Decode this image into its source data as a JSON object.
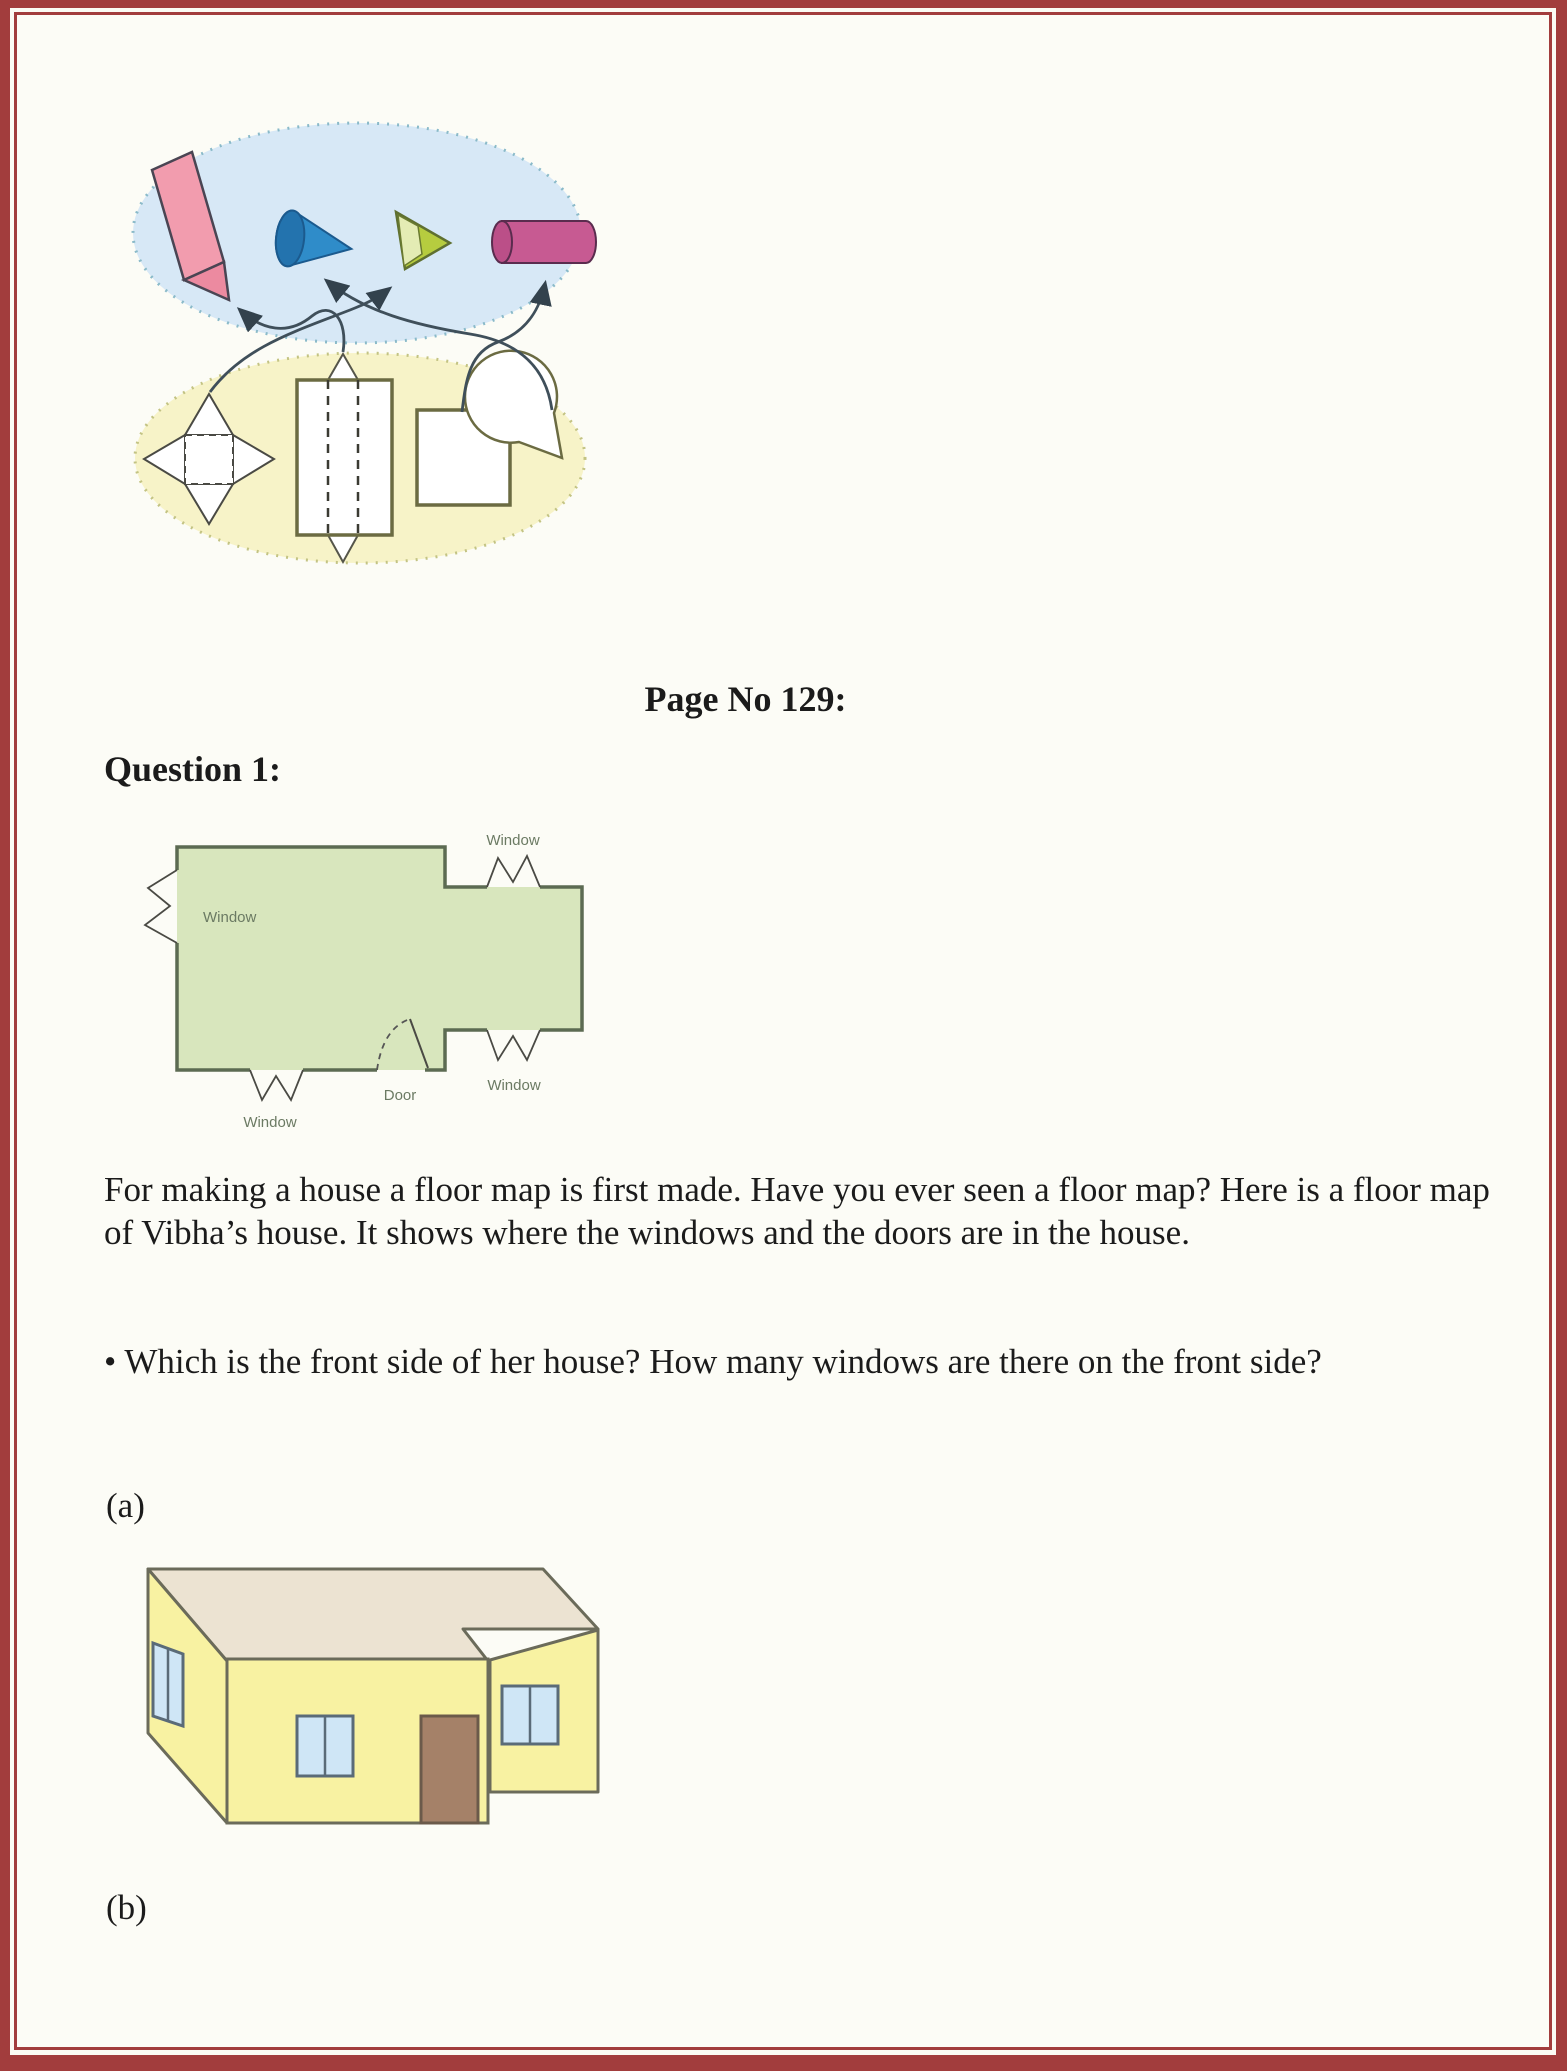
{
  "page": {
    "heading": "Page No 129:",
    "question_label": "Question 1:",
    "paragraph": "For making a house a floor map is first made. Have you ever seen a floor map? Here is a floor map of Vibha’s house. It shows where the windows and the doors are in the house.",
    "bullet": "• Which is the front side of her house? How many windows are there on the front side?",
    "option_a": "(a)",
    "option_b": "(b)"
  },
  "matching_diagram": {
    "solids": [
      "crayon",
      "cone",
      "pyramid",
      "cylinder"
    ],
    "nets": [
      "pyramid-net",
      "prism-net",
      "square",
      "circle-with-wedge"
    ],
    "matches": [
      {
        "from": "prism-net",
        "to": "crayon"
      },
      {
        "from": "pyramid-net",
        "to": "pyramid"
      },
      {
        "from": "circle-with-wedge",
        "to": "cone"
      },
      {
        "from": "square",
        "to": "cylinder"
      }
    ],
    "colors": {
      "solids_ellipse_fill": "#d7e8f6",
      "solids_ellipse_dots": "#8abac9",
      "nets_ellipse_fill": "#f7f3c8",
      "nets_ellipse_dots": "#c3c383",
      "crayon": "#f29cae",
      "cone": "#2f8cc9",
      "cone_base": "#2373ae",
      "pyramid": "#b6cc3f",
      "pyramid_light_face": "#e4ecb4",
      "cylinder": "#c75a92",
      "arrow": "#3f4f5a"
    }
  },
  "floor_map": {
    "labels": {
      "window": "Window",
      "door": "Door"
    },
    "fill": "#d8e6bd",
    "wall": "#5c6b52"
  },
  "house": {
    "wall": "#f8f2a2",
    "roof": "#ece3d2",
    "door": "#a58168",
    "window": "#cfe6f6",
    "outline": "#6b6b5a"
  },
  "frame_color": "#a23d3d"
}
